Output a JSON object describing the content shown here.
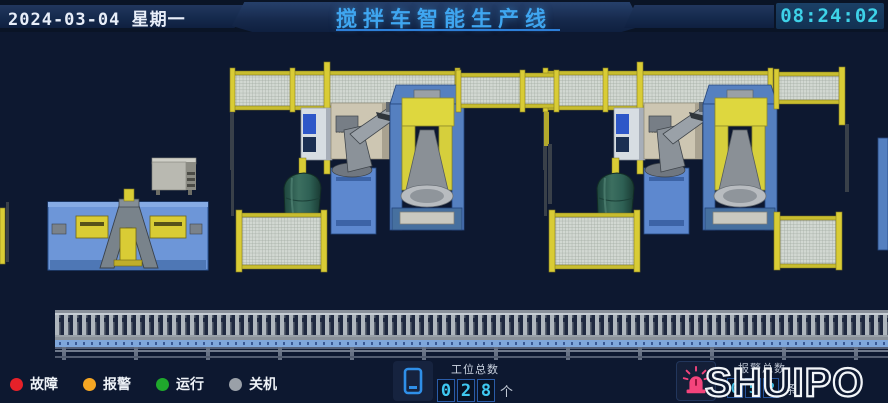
{
  "header": {
    "date": "2024-03-04",
    "weekday": "星期一",
    "title": "搅拌车智能生产线",
    "time": "08:24:02"
  },
  "legend": {
    "items": [
      {
        "label": "故障",
        "color": "#e62129"
      },
      {
        "label": "报警",
        "color": "#f5a623"
      },
      {
        "label": "运行",
        "color": "#1fa82c"
      },
      {
        "label": "关机",
        "color": "#9aa0a8"
      }
    ]
  },
  "counters": {
    "stations": {
      "label": "工位总数",
      "digits": [
        "0",
        "2",
        "8"
      ],
      "unit": "个"
    },
    "alarms": {
      "label": "报警总数",
      "digits": [
        "0",
        "5",
        "2"
      ],
      "unit": "条"
    }
  },
  "brand": {
    "logo": "SHUIPO"
  },
  "scene": {
    "robot_brand": "KUKA"
  },
  "colors": {
    "title_blue": "#3fa6f0",
    "clock_cyan": "#3ed2e8",
    "digit_cyan": "#3fc8f0",
    "digit_border": "#2a5ca8",
    "fence_yellow": "#d9cc35",
    "machine_blue": "#5580c0",
    "tank_green": "#2e6054",
    "beacon_pink": "#f4447c",
    "background": "#0d1830"
  }
}
